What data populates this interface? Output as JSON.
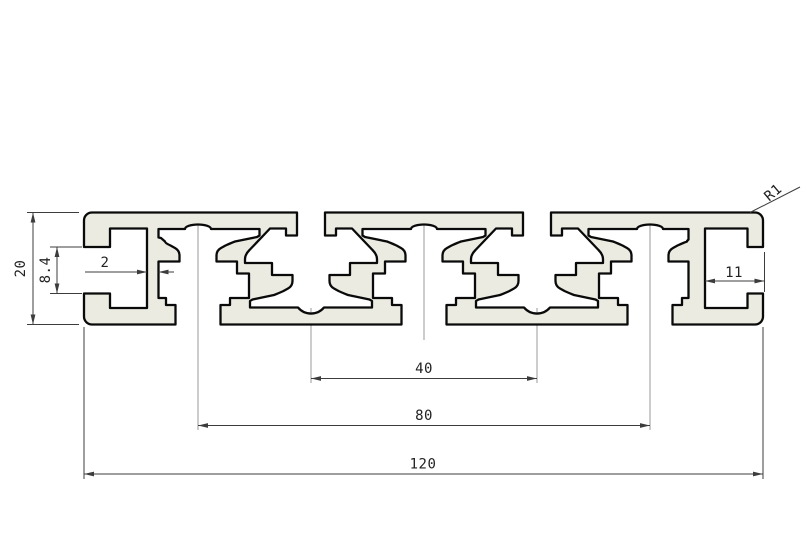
{
  "drawing": {
    "title": "aluminium-profile-cross-section",
    "dimensions": {
      "overall_width": "120",
      "boss_pitch_outer": "80",
      "boss_pitch_inner": "40",
      "overall_height": "20",
      "end_slot_opening_height": "8.4",
      "rib_wall_thickness": "2",
      "end_slot_depth": "11",
      "corner_radius": "R1"
    }
  },
  "colors": {
    "background": "#ffffff",
    "profile_fill": "#ebebe2",
    "outline": "#0a0a0a",
    "dimension_line": "#3c3c3c",
    "centerline": "#9a9a9a",
    "text": "#222222"
  }
}
